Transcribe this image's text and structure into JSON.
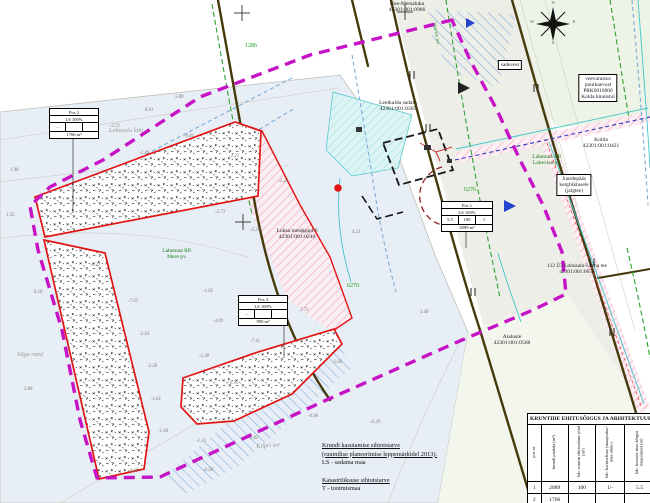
{
  "colors": {
    "planning_boundary": "#c513c5",
    "plot_outline": "#e21414",
    "road": "#463a0c",
    "water": "#e7eef5",
    "green_dash": "#2ca32c",
    "blue_dash": "#7cabd6",
    "pink_hatch": "#eba7c0",
    "green_label": "#157a15"
  },
  "compass": {
    "n": "N",
    "e": "E",
    "s": "S",
    "w": "W"
  },
  "map_labels": [
    {
      "lines": [
        "Uue-Metsaluka",
        "42301:001:0966"
      ],
      "x": 407,
      "y": 1,
      "size": 5.6
    },
    {
      "lines": [
        "Leetkalda sadam",
        "42301:001:0365"
      ],
      "x": 398,
      "y": 100,
      "size": 5.6
    },
    {
      "lines": [
        "Kolda",
        "42301:001:0421"
      ],
      "x": 601,
      "y": 137,
      "size": 5.6
    },
    {
      "lines": [
        "Loksa metskond 6",
        "42301:001:0240"
      ],
      "x": 297,
      "y": 228,
      "size": 5.6
    },
    {
      "lines": [
        "Aialuste",
        "42301:001:0568"
      ],
      "x": 512,
      "y": 334,
      "size": 5.6
    },
    {
      "lines": [
        "112 Ü3 Lohusalu-Leena tee",
        "42301:001:0655"
      ],
      "x": 577,
      "y": 263,
      "size": 5.4
    },
    {
      "lines": [
        "Lahemaa RP.",
        "Mere pv."
      ],
      "x": 177,
      "y": 248,
      "size": 5.6,
      "color": "#157a15"
    },
    {
      "lines": [
        "Lahemaa RP.",
        "Lahevisa pv."
      ],
      "x": 547,
      "y": 154,
      "size": 5.6,
      "color": "#157a15"
    },
    {
      "lines": [
        "sadevesi"
      ],
      "x": 510,
      "y": 60,
      "size": 5.4,
      "box": true
    },
    {
      "lines": [
        "veevarustus",
        "puurkaevust",
        "PRK0016000",
        "Kolda kinnistul"
      ],
      "x": 598,
      "y": 74,
      "size": 5.4,
      "box": true
    },
    {
      "lines": [
        "Juurdepääs",
        "kergliiklusele",
        "(jalgtee)"
      ],
      "x": 574,
      "y": 174,
      "size": 5.4,
      "box": true
    },
    {
      "lines": [
        "1286"
      ],
      "x": 251,
      "y": 43,
      "size": 6,
      "color": "#18a018"
    },
    {
      "lines": [
        "6276"
      ],
      "x": 470,
      "y": 187,
      "size": 6,
      "color": "#18a018"
    },
    {
      "lines": [
        "6270"
      ],
      "x": 353,
      "y": 283,
      "size": 6,
      "color": "#18a018"
    },
    {
      "lines": [
        "Lohusalu laht"
      ],
      "x": 126,
      "y": 128,
      "size": 6.2,
      "color": "#9a9a94",
      "italic": true
    },
    {
      "lines": [
        "Silgu rand"
      ],
      "x": 30,
      "y": 352,
      "size": 6.2,
      "color": "#9a9a94",
      "italic": true
    },
    {
      "lines": [
        "Kilpri tee"
      ],
      "x": 268,
      "y": 444,
      "size": 6.2,
      "color": "#9a9a94",
      "italic": true,
      "rotate": -4
    },
    {
      "lines": [
        "Veerise tee"
      ],
      "x": 436,
      "y": 22,
      "size": 5.2,
      "color": "#2f9a2f",
      "rotate": 80,
      "align": "l"
    },
    {
      "lines": [
        "N"
      ],
      "x": 553,
      "y": 0,
      "size": 4.6,
      "color": "#555"
    },
    {
      "lines": [
        "E"
      ],
      "x": 574,
      "y": 19,
      "size": 4.6,
      "color": "#555"
    },
    {
      "lines": [
        "S"
      ],
      "x": 553,
      "y": 40,
      "size": 4.6,
      "color": "#555"
    },
    {
      "lines": [
        "W"
      ],
      "x": 532,
      "y": 19,
      "size": 4.6,
      "color": "#555"
    }
  ],
  "spot_elevations": [
    {
      "x": 10,
      "y": 168,
      "v": "1.98"
    },
    {
      "x": 6,
      "y": 213,
      "v": "1.55"
    },
    {
      "x": 34,
      "y": 290,
      "v": "0.18"
    },
    {
      "x": 24,
      "y": 387,
      "v": "2.88"
    },
    {
      "x": 90,
      "y": 263,
      "v": "-0.32"
    },
    {
      "x": 128,
      "y": 299,
      "v": "-7.02"
    },
    {
      "x": 139,
      "y": 332,
      "v": "-2.34"
    },
    {
      "x": 147,
      "y": 364,
      "v": "-2.28"
    },
    {
      "x": 151,
      "y": 397,
      "v": "-1.61"
    },
    {
      "x": 158,
      "y": 429,
      "v": "-1.44"
    },
    {
      "x": 128,
      "y": 469,
      "v": "-0.85"
    },
    {
      "x": 203,
      "y": 289,
      "v": "-1.05"
    },
    {
      "x": 213,
      "y": 319,
      "v": "-3.09"
    },
    {
      "x": 199,
      "y": 354,
      "v": "-1.38"
    },
    {
      "x": 228,
      "y": 381,
      "v": "-0.95"
    },
    {
      "x": 250,
      "y": 339,
      "v": "-7.41"
    },
    {
      "x": 196,
      "y": 439,
      "v": "-1.33"
    },
    {
      "x": 248,
      "y": 436,
      "v": "-2.82"
    },
    {
      "x": 308,
      "y": 414,
      "v": "-0.96"
    },
    {
      "x": 203,
      "y": 468,
      "v": "-6.58"
    },
    {
      "x": 110,
      "y": 124,
      "v": "-2.71"
    },
    {
      "x": 139,
      "y": 151,
      "v": "-2.49"
    },
    {
      "x": 184,
      "y": 134,
      "v": "-0.41"
    },
    {
      "x": 229,
      "y": 154,
      "v": "-2.23"
    },
    {
      "x": 278,
      "y": 179,
      "v": "-2.26"
    },
    {
      "x": 215,
      "y": 210,
      "v": "-2.73"
    },
    {
      "x": 300,
      "y": 230,
      "v": "-3.05"
    },
    {
      "x": 175,
      "y": 95,
      "v": "5.89"
    },
    {
      "x": 145,
      "y": 108,
      "v": "8.01"
    },
    {
      "x": 352,
      "y": 230,
      "v": "4.23"
    },
    {
      "x": 420,
      "y": 310,
      "v": "3.48"
    },
    {
      "x": 300,
      "y": 308,
      "v": "2.73"
    },
    {
      "x": 332,
      "y": 360,
      "v": "-1.06"
    },
    {
      "x": 370,
      "y": 420,
      "v": "-0.39"
    },
    {
      "x": 250,
      "y": 228,
      "v": "-2.20"
    }
  ],
  "info_boxes": [
    {
      "x": 49,
      "y": 108,
      "w": 48,
      "pos": "Pos 2",
      "use": "LS 100%",
      "cells": [
        "–",
        "",
        ""
      ],
      "area": "1766 m²"
    },
    {
      "x": 441,
      "y": 201,
      "w": 50,
      "pos": "Pos 1",
      "use": "LS 100%",
      "cells": [
        "5,5",
        "100",
        "1"
      ],
      "area": "2089 m²"
    },
    {
      "x": 238,
      "y": 295,
      "w": 48,
      "pos": "Pos 3",
      "use": "LS 100%",
      "cells": [
        "–",
        "",
        ""
      ],
      "area": "990 m²"
    }
  ],
  "legend": {
    "lines": [
      {
        "text": "Krundi kasutamise sihtotstarve",
        "underline": true
      },
      {
        "text": "(ruumilise planeerimise leppemärkidel 2013).",
        "underline": true
      },
      {
        "text": "LS - sadama maa",
        "underline": false
      },
      {
        "text": "",
        "underline": false
      },
      {
        "text": "Katastriüksuse sihtotstarve",
        "underline": true
      },
      {
        "text": "T - tootmismaa",
        "underline": false
      },
      {
        "text": "",
        "underline": false
      },
      {
        "text": "Piirnevad:",
        "underline": true
      }
    ]
  },
  "building_rights_table": {
    "title": "KRUNTIDE EHITUSÕIGUS JA ARHITEKTUUR",
    "col_widths": [
      13,
      27,
      27,
      29,
      30
    ],
    "columns": [
      "pos nr.",
      "krundi pindala (m²)",
      "lub. suurim ehitisealune pind (m²)",
      "lub. korruselisus (maapealne/ maa-alune)",
      "lub. hoonete max kõrgus maapinnast (m)"
    ],
    "rows": [
      [
        "1",
        "2089",
        "100",
        "1/-",
        "5.5"
      ],
      [
        "2",
        "1766",
        "",
        "",
        ""
      ]
    ]
  }
}
